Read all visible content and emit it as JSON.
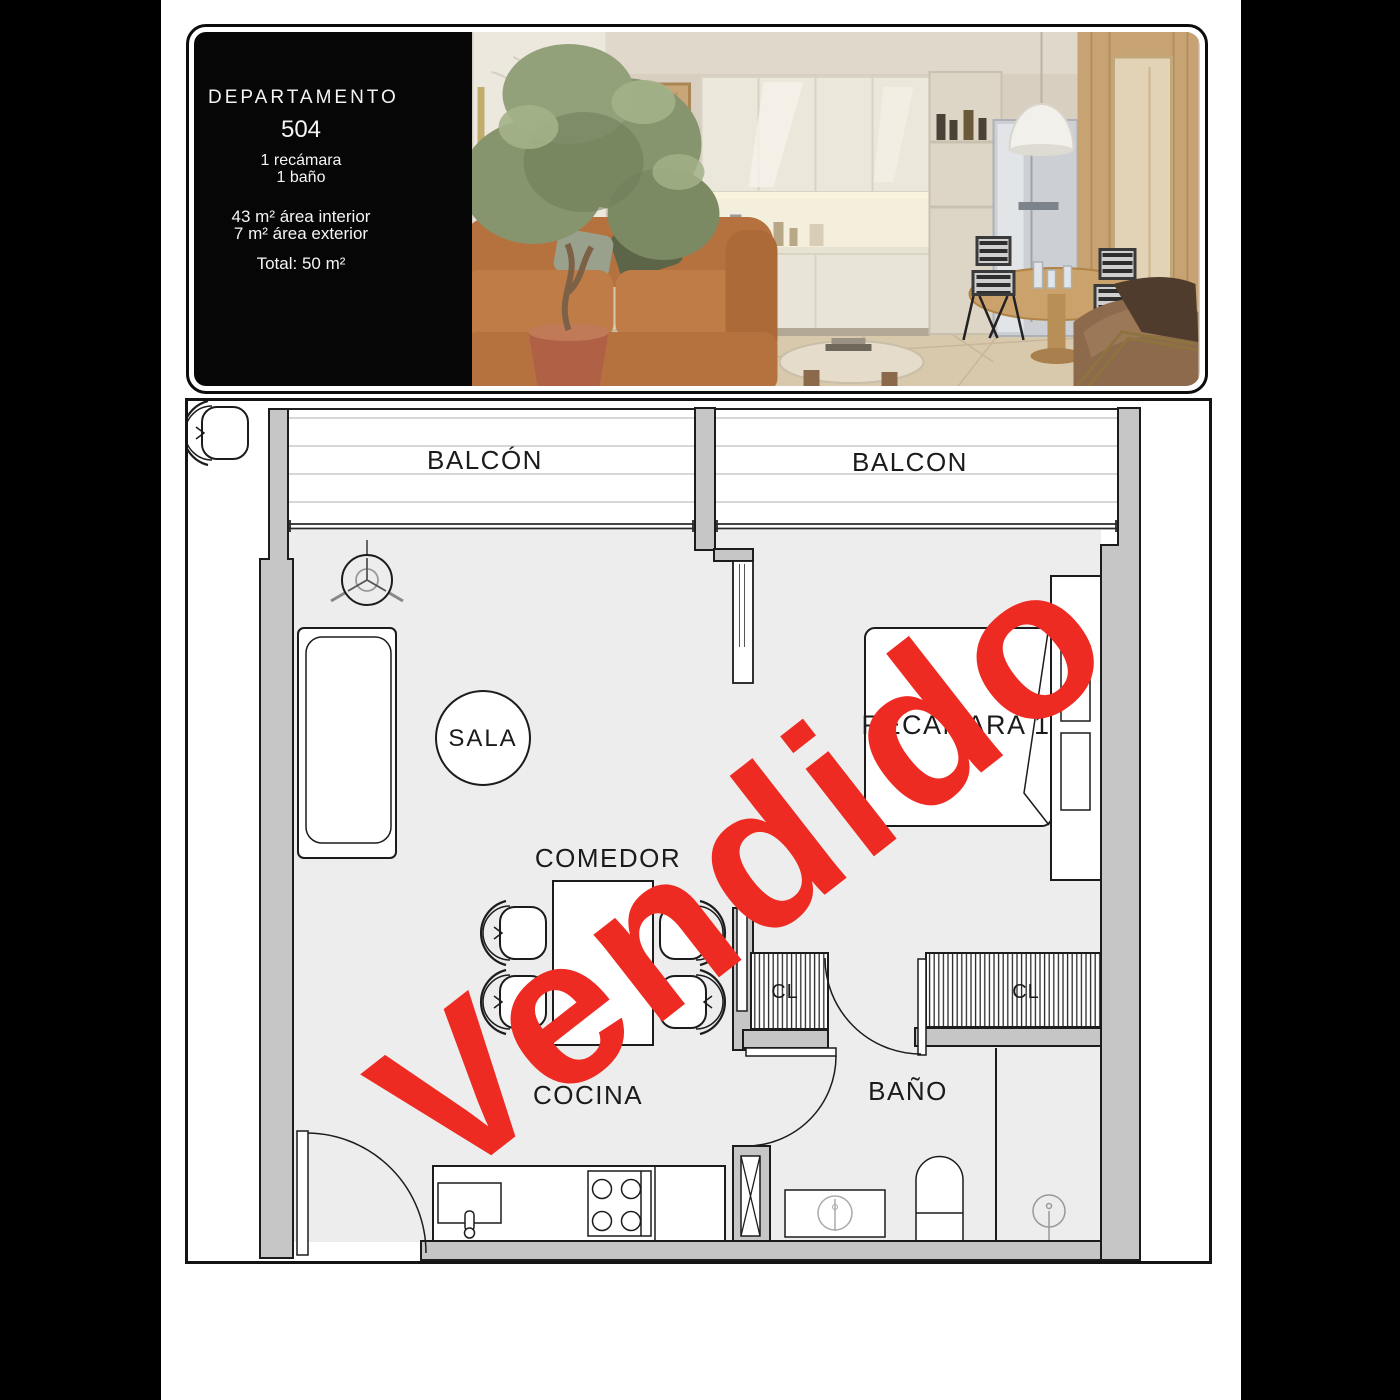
{
  "card": {
    "title": "DEPARTAMENTO",
    "unit_number": "504",
    "bedrooms": "1 recámara",
    "bathrooms": "1 baño",
    "interior_area": "43 m² área interior",
    "exterior_area": "7 m² área exterior",
    "total_area": "Total: 50 m²"
  },
  "floor_plan": {
    "labels": {
      "balcony_left": "BALCÓN",
      "balcony_right": "BALCON",
      "living": "SALA",
      "dining": "COMEDOR",
      "bedroom": "RECAMARA 1",
      "kitchen": "COCINA",
      "bathroom": "BAÑO",
      "closet_1": "CL",
      "closet_2": "CL"
    },
    "colors": {
      "wall_fill": "#c6c6c6",
      "line": "#1c1c1c",
      "floor": "#ededed",
      "deck_line": "#d6d6d6"
    }
  },
  "stamp": {
    "text": "Vendido",
    "color": "#ee2b22",
    "rotation_deg": -38
  }
}
